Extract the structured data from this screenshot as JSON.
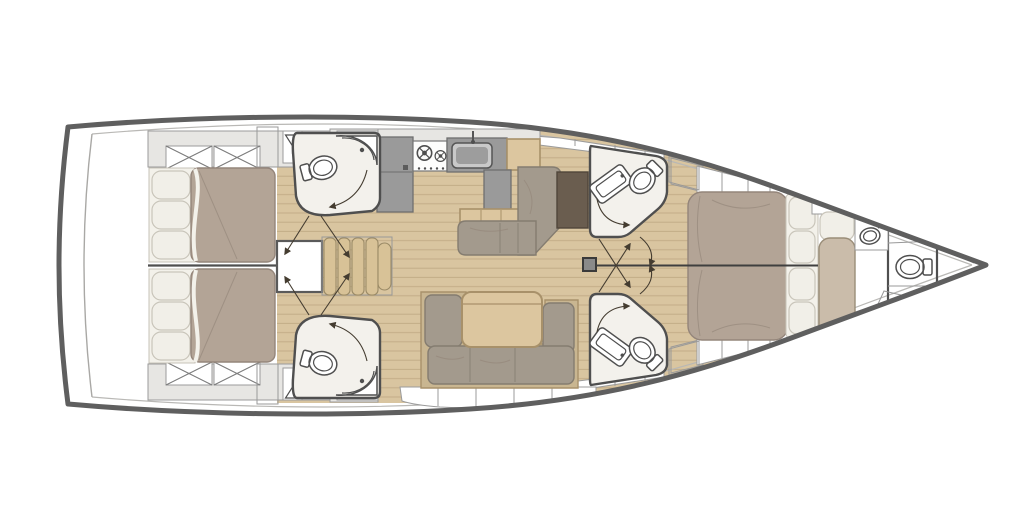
{
  "figure": {
    "kind": "yacht-interior-floor-plan",
    "orientation": "bow-right",
    "parts": [
      "hull",
      "transom-platform",
      "aft-cabin-port-bed",
      "aft-cabin-starboard-bed",
      "storage-lockers-x",
      "louver-vents",
      "hanging-lockers",
      "aft-head-port",
      "aft-head-starboard",
      "engine-hatch",
      "companionway-stairs",
      "galley-fridge",
      "galley-stove",
      "galley-sink",
      "galley-peninsula",
      "galley-sideboard",
      "salon-sofa-upper",
      "salon-table-dark",
      "salon-sofa-lower",
      "salon-table-wood",
      "mast-step",
      "mid-head-port",
      "mid-head-starboard",
      "forward-island-berth",
      "forward-pillows",
      "forward-seat",
      "forward-side-shelves",
      "forward-head-sink",
      "forward-head-toilet",
      "shower-grate",
      "bow-locker",
      "door-swing-arrows",
      "centerline"
    ]
  },
  "colors": {
    "hull": "#5f5f5f",
    "deckGray": "#e7e6e3",
    "deckLine": "#9b9b9b",
    "wood": "#d9c5a0",
    "woodLine": "#c2ac87",
    "bath": "#f3f1ec",
    "wall": "#4f4f4f",
    "mattress": "#b3a496",
    "mattressLine": "#94857a",
    "pillow": "#f1efe8",
    "pillowLine": "#c9c5ba",
    "sofa": "#a39a8d",
    "sofaLine": "#847c70",
    "frame": "#c9b691",
    "tableWood": "#dcc69f",
    "tableWoodLine": "#a8916a",
    "tableDark": "#6a5d4f",
    "counter": "#9a9a9a",
    "counterLine": "#6f6f6f",
    "stair": "#d8c297",
    "stairLine": "#9a8a66",
    "fixtureLine": "#4f4f4f",
    "arrow": "#443c30",
    "louver": "#55524c",
    "seat": "#cabcaa"
  }
}
